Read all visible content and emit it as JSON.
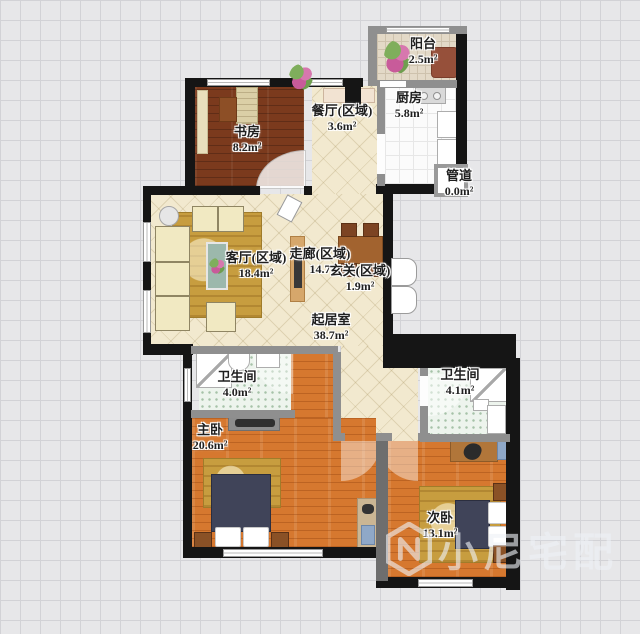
{
  "app": {
    "type": "apartment-floor-plan"
  },
  "watermark": {
    "brand": "小尼宅配"
  },
  "rooms": {
    "balcony": {
      "name": "阳台",
      "area": "2.5m²"
    },
    "kitchen": {
      "name": "厨房",
      "area": "5.8m²"
    },
    "duct": {
      "name": "管道",
      "area": "0.0m²"
    },
    "dining_zone": {
      "name": "餐厅(区域)",
      "area": "3.6m²"
    },
    "study": {
      "name": "书房",
      "area": "8.2m²"
    },
    "living_zone": {
      "name": "客厅(区域)",
      "area": "18.4m²"
    },
    "corridor_zone": {
      "name": "走廊(区域)",
      "area": "14.7"
    },
    "foyer_zone": {
      "name": "玄关(区域)",
      "area": "1.9m²"
    },
    "living_room": {
      "name": "起居室",
      "area": "38.7m²"
    },
    "bath_left": {
      "name": "卫生间",
      "area": "4.0m²"
    },
    "bath_right": {
      "name": "卫生间",
      "area": "4.1m²"
    },
    "master": {
      "name": "主卧",
      "area": "20.6m²"
    },
    "second": {
      "name": "次卧",
      "area": "13.1m²"
    }
  },
  "colors": {
    "wall": "#151515",
    "inner_wall": "#8f8f8f",
    "living_floor": "#f2e9cf",
    "study_floor": "#7b3a1d",
    "bedroom_floor": "#d6782f",
    "bath_floor": "#edf4ed",
    "bed_blanket": "#404459",
    "rug_gold": "#c79d3f",
    "grid_bg": "#e7e7e9"
  }
}
